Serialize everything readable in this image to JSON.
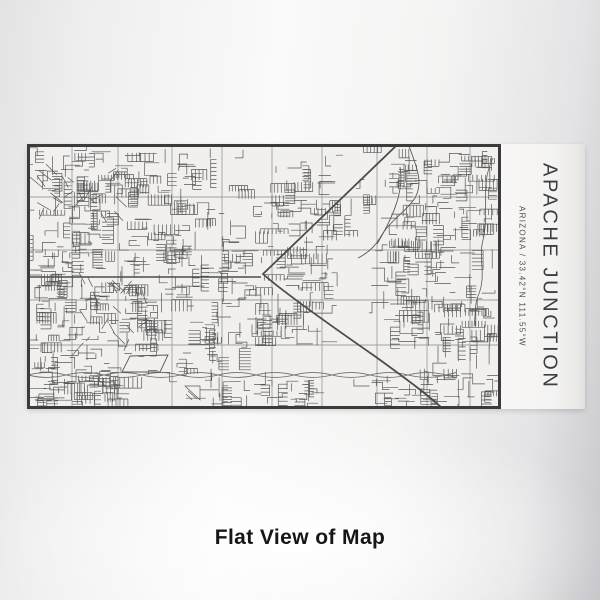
{
  "scene": {
    "caption": "Flat View of Map"
  },
  "label": {
    "title": "APACHE JUNCTION",
    "subtitle": "ARIZONA / 33.42°N 111.55°W",
    "text_color": "#3e3e3e"
  },
  "map": {
    "width": 474,
    "height": 265,
    "colors": {
      "bg": "#f1f0ee",
      "border": "#3b3b3b",
      "major": "#a0a09f",
      "minor": "#585858",
      "highway": "#4b4b4b",
      "canal": "#6e6e6e"
    },
    "grid": {
      "vx": [
        45,
        91,
        145,
        195,
        245,
        295,
        350,
        400,
        443
      ],
      "hy": [
        53,
        106,
        156,
        201
      ]
    },
    "canal": {
      "y": 231,
      "x0": 1,
      "x1": 420,
      "amp": 2.4,
      "wl": 38
    },
    "specials": [
      {
        "d": "M0,133 H234",
        "color": "highway",
        "w": 1.5
      },
      {
        "d": "M371,0 L236,130 C254,146 300,179 349,213 C382,237 401,251 416,265",
        "color": "highway",
        "w": 1.8
      },
      {
        "d": "M103,212 L141,211 L133,228 L95,228 Z",
        "color": "minor",
        "w": 0.9
      },
      {
        "d": "M382,2 C389,22 397,38 388,54 C379,68 362,77 353,94 C347,104 339,110 331,114",
        "color": "minor",
        "w": 0.9
      },
      {
        "d": "M466,14 C452,42 463,68 456,96 C451,114 460,132 451,152 C447,162 449,172 447,182",
        "color": "minor",
        "w": 0.8
      },
      {
        "d": "M373,23 C377,45 368,70 350,100",
        "color": "minor",
        "w": 0.9
      },
      {
        "d": "M158,242 L173,242 L173,256 Z M160,244 l11,10 M161,247 l9,8 M159,250 l6,6",
        "color": "minor",
        "w": 0.7
      }
    ],
    "clusters": [
      {
        "x": 4,
        "y": 4,
        "w": 168,
        "h": 46,
        "n": 70,
        "seed": 11
      },
      {
        "x": 8,
        "y": 28,
        "w": 85,
        "h": 42,
        "n": 22,
        "seed": 12,
        "diag": true
      },
      {
        "x": 4,
        "y": 56,
        "w": 64,
        "h": 146,
        "n": 95,
        "seed": 13
      },
      {
        "x": 70,
        "y": 56,
        "w": 152,
        "h": 146,
        "n": 150,
        "seed": 14
      },
      {
        "x": 45,
        "y": 130,
        "w": 70,
        "h": 70,
        "n": 20,
        "seed": 28,
        "diag": true
      },
      {
        "x": 225,
        "y": 56,
        "w": 82,
        "h": 98,
        "n": 70,
        "seed": 15
      },
      {
        "x": 175,
        "y": 4,
        "w": 118,
        "h": 44,
        "n": 14,
        "seed": 16
      },
      {
        "x": 300,
        "y": 6,
        "w": 52,
        "h": 82,
        "n": 14,
        "seed": 17
      },
      {
        "x": 358,
        "y": 4,
        "w": 108,
        "h": 48,
        "n": 50,
        "seed": 18
      },
      {
        "x": 358,
        "y": 58,
        "w": 108,
        "h": 96,
        "n": 85,
        "seed": 19
      },
      {
        "x": 356,
        "y": 156,
        "w": 112,
        "h": 46,
        "n": 45,
        "seed": 27
      },
      {
        "x": 416,
        "y": 158,
        "w": 52,
        "h": 68,
        "n": 16,
        "seed": 20
      },
      {
        "x": 225,
        "y": 158,
        "w": 70,
        "h": 44,
        "n": 38,
        "seed": 21
      },
      {
        "x": 4,
        "y": 203,
        "w": 218,
        "h": 26,
        "n": 36,
        "seed": 22
      },
      {
        "x": 4,
        "y": 236,
        "w": 92,
        "h": 25,
        "n": 48,
        "seed": 23
      },
      {
        "x": 175,
        "y": 236,
        "w": 118,
        "h": 25,
        "n": 34,
        "seed": 24
      },
      {
        "x": 340,
        "y": 233,
        "w": 82,
        "h": 27,
        "n": 32,
        "seed": 25
      },
      {
        "x": 428,
        "y": 230,
        "w": 40,
        "h": 30,
        "n": 13,
        "seed": 26
      }
    ]
  }
}
